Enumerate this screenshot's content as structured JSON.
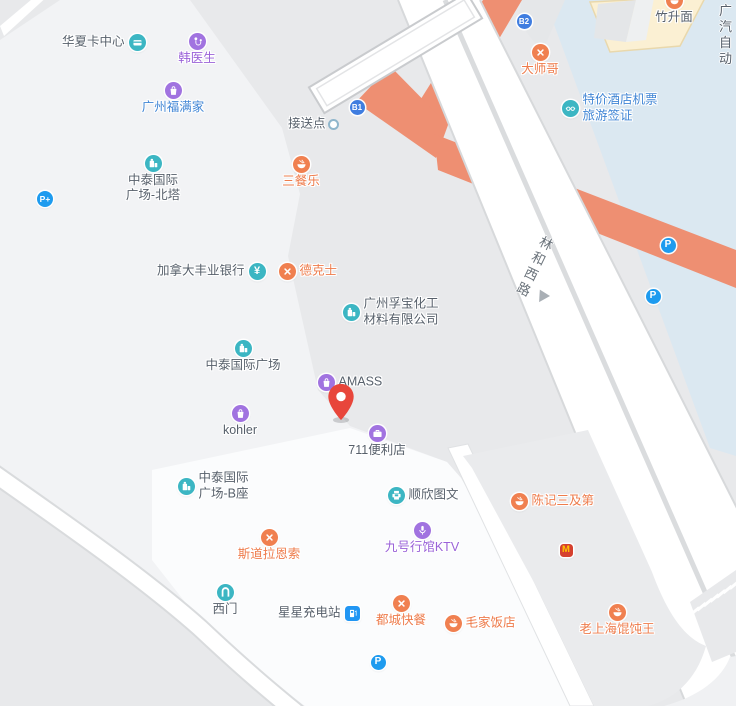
{
  "colors": {
    "base_gray": "#e8e9eb",
    "block_light": "#f2f3f5",
    "block_lighter": "#fbfcfd",
    "block_mid": "#eaebed",
    "water_blue": "#dbe8f1",
    "cream_building": "#fbf0d3",
    "cream_outline": "#e9d8ac",
    "road_white": "#ffffff",
    "road_casing": "#d7d9db",
    "road_orange": "#ee8f72",
    "teal": "#3cb6c3",
    "purple": "#a173e0",
    "orange_icon": "#f08050",
    "parking_blue": "#1e9bef",
    "badge_blue": "#3f7de0",
    "mcd_red": "#d5402e",
    "mcd_yellow": "#ffc400",
    "pin_red": "#e8463b",
    "dot_ring": "#8fb6cc"
  },
  "map": {
    "road_label": {
      "text": "林和西路",
      "x": 543,
      "y": 236,
      "arrow_x": 536,
      "arrow_y": 292
    },
    "corner_text": {
      "line1": "广汽",
      "line2": "自动",
      "x": 719,
      "y": 3
    },
    "badges": [
      {
        "id": "exit-b1",
        "text": "B1",
        "x": 357,
        "y": 107
      },
      {
        "id": "exit-b2",
        "text": "B2",
        "x": 524,
        "y": 21
      }
    ],
    "pin": {
      "x": 341,
      "y": 420
    },
    "pois": [
      {
        "id": "huaxia-card-center",
        "icon": "card",
        "x": 137,
        "y": 42,
        "lines": [
          "华夏卡中心"
        ],
        "pos": "left",
        "color": "dark"
      },
      {
        "id": "doctor-han",
        "icon": "medical",
        "x": 197,
        "y": 41,
        "lines": [
          "韩医生"
        ],
        "pos": "below",
        "color": "purple"
      },
      {
        "id": "guangzhou-fumanjia",
        "icon": "bag",
        "x": 173,
        "y": 90,
        "lines": [
          "广州福满家"
        ],
        "pos": "below",
        "color": "blue"
      },
      {
        "id": "zhongtai-north-tower",
        "icon": "building",
        "x": 153,
        "y": 163,
        "lines": [
          "中泰国际",
          "广场-北塔"
        ],
        "pos": "below",
        "color": "dark"
      },
      {
        "id": "park-and-ride",
        "icon": "parkingplus",
        "x": 45,
        "y": 199
      },
      {
        "id": "sancanle",
        "icon": "bowl",
        "x": 301,
        "y": 164,
        "lines": [
          "三餐乐"
        ],
        "pos": "below",
        "color": "orange"
      },
      {
        "id": "scotiabank-canada",
        "icon": "yen",
        "x": 257,
        "y": 271,
        "lines": [
          "加拿大丰业银行"
        ],
        "pos": "left",
        "color": "dark"
      },
      {
        "id": "dicos",
        "icon": "utensils",
        "x": 287,
        "y": 271,
        "lines": [
          "德克士"
        ],
        "pos": "right",
        "color": "orange"
      },
      {
        "id": "pickup-point",
        "icon": "dot",
        "x": 333,
        "y": 124,
        "lines": [
          "接送点"
        ],
        "pos": "left",
        "color": "dark"
      },
      {
        "id": "dashige",
        "icon": "utensils",
        "x": 540,
        "y": 52,
        "lines": [
          "大师哥"
        ],
        "pos": "below",
        "color": "orange"
      },
      {
        "id": "hotel-ticket-visa",
        "icon": "glasses",
        "x": 570,
        "y": 108,
        "lines": [
          "特价酒店机票",
          "旅游签证"
        ],
        "pos": "right",
        "color": "blue"
      },
      {
        "id": "zhushengmian",
        "icon": "bowl",
        "x": 674,
        "y": 0,
        "lines": [
          "竹升面"
        ],
        "pos": "below",
        "color": "dark"
      },
      {
        "id": "fubao-chemical",
        "icon": "building",
        "x": 351,
        "y": 312,
        "lines": [
          "广州孚宝化工",
          "材料有限公司"
        ],
        "pos": "right",
        "color": "dark"
      },
      {
        "id": "zhongtai-plaza",
        "icon": "building",
        "x": 243,
        "y": 348,
        "lines": [
          "中泰国际广场"
        ],
        "pos": "below",
        "color": "dark"
      },
      {
        "id": "amass",
        "icon": "bag",
        "x": 326,
        "y": 382,
        "lines": [
          "AMASS"
        ],
        "pos": "right",
        "color": "dark"
      },
      {
        "id": "kohler",
        "icon": "bag",
        "x": 240,
        "y": 413,
        "lines": [
          "kohler"
        ],
        "pos": "below",
        "color": "dark"
      },
      {
        "id": "711-store",
        "icon": "briefcase",
        "x": 377,
        "y": 433,
        "lines": [
          "711便利店"
        ],
        "pos": "below",
        "color": "dark"
      },
      {
        "id": "zhongtai-tower-b",
        "icon": "building",
        "x": 186,
        "y": 486,
        "lines": [
          "中泰国际",
          "广场-B座"
        ],
        "pos": "right",
        "color": "dark"
      },
      {
        "id": "shunxin-print",
        "icon": "printer",
        "x": 396,
        "y": 495,
        "lines": [
          "顺欣图文"
        ],
        "pos": "right",
        "color": "dark"
      },
      {
        "id": "chenji-sanjidi",
        "icon": "bowl",
        "x": 519,
        "y": 501,
        "lines": [
          "陈记三及第"
        ],
        "pos": "right",
        "color": "orange"
      },
      {
        "id": "stora-enso",
        "icon": "utensils",
        "x": 269,
        "y": 537,
        "lines": [
          "斯道拉恩索"
        ],
        "pos": "below",
        "color": "orange"
      },
      {
        "id": "ktv-no9",
        "icon": "mic",
        "x": 422,
        "y": 530,
        "lines": [
          "九号行馆KTV"
        ],
        "pos": "below",
        "color": "purple"
      },
      {
        "id": "mcdonalds",
        "icon": "mcd",
        "x": 566,
        "y": 550
      },
      {
        "id": "west-gate",
        "icon": "gate",
        "x": 225,
        "y": 592,
        "lines": [
          "西门"
        ],
        "pos": "below",
        "color": "dark"
      },
      {
        "id": "star-charging",
        "icon": "charging",
        "x": 352,
        "y": 613,
        "lines": [
          "星星充电站"
        ],
        "pos": "left",
        "color": "dark"
      },
      {
        "id": "ducheng-fastfood",
        "icon": "utensils",
        "x": 401,
        "y": 603,
        "lines": [
          "都城快餐"
        ],
        "pos": "below",
        "color": "orange"
      },
      {
        "id": "maojia-restaurant",
        "icon": "bowl",
        "x": 453,
        "y": 623,
        "lines": [
          "毛家饭店"
        ],
        "pos": "right",
        "color": "orange"
      },
      {
        "id": "old-shanghai-wonton",
        "icon": "bowl",
        "x": 617,
        "y": 612,
        "lines": [
          "老上海馄饨王"
        ],
        "pos": "below",
        "color": "orange"
      },
      {
        "id": "parking-north",
        "icon": "parking",
        "x": 668,
        "y": 245
      },
      {
        "id": "parking-mid",
        "icon": "parking",
        "x": 653,
        "y": 296
      },
      {
        "id": "parking-south",
        "icon": "parking",
        "x": 378,
        "y": 662
      }
    ]
  }
}
